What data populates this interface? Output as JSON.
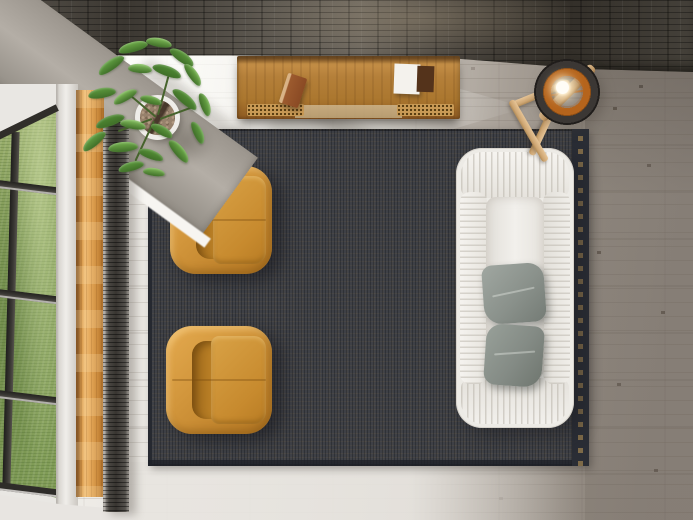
{
  "meta": {
    "type": "natural-image",
    "caption": "Top-down view of a modern living room: a dark patchwork rug with concentric square motifs, two tan leather armchairs facing a white slipcovered sofa with two gray pillows, a wooden sideboard with vents against a dark stone accent wall, a ring floor lamp with a lit bulb on a wooden tripod, a potted green plant in a white planter, a column radiator, and tall grid windows overlooking a green lawn over gray wood plank flooring."
  },
  "palette": {
    "wall": "#46413a",
    "beam_concrete": "#b4aea6",
    "floor_light": "#ebe8e3",
    "floor_dark": "#8d857d",
    "rug_base": "#3e4046",
    "rug_gold": "#9c7f49",
    "chair_leather": "#d0943a",
    "sofa": "#edebe6",
    "pillow": "#8a918b",
    "sideboard_wood": "#b5803a",
    "lamp_inner": "#b5641c",
    "lamp_shell": "#3b3734",
    "tripod_wood": "#cda572",
    "plant_green": "#6fae4a",
    "grass": "#8aa35e",
    "window_trim_wood": "#e2a455",
    "radiator": "#383531"
  },
  "objects": {
    "wall": {
      "label": "dark stone accent wall"
    },
    "beam": {
      "label": "concrete ceiling beam over window"
    },
    "window": {
      "label": "grid window overlooking green lawn"
    },
    "radiator": {
      "label": "wall column radiator"
    },
    "plant": {
      "label": "potted green plant in white planter with pebbles"
    },
    "sideboard": {
      "label": "wood media sideboard",
      "items": [
        "small brown book",
        "white booklet",
        "dark case"
      ],
      "vents": 2
    },
    "lamp": {
      "label": "ring floor lamp on wooden tripod",
      "bulb": "lit"
    },
    "rug": {
      "label": "patchwork rug with concentric square motif",
      "tiles": [
        6,
        5
      ]
    },
    "armchairs": {
      "label": "tan leather lounge chairs",
      "count": 2
    },
    "sofa": {
      "label": "white slipcovered sofa",
      "pillow_count": 2
    },
    "floor": {
      "label": "gray wood plank floor"
    }
  }
}
